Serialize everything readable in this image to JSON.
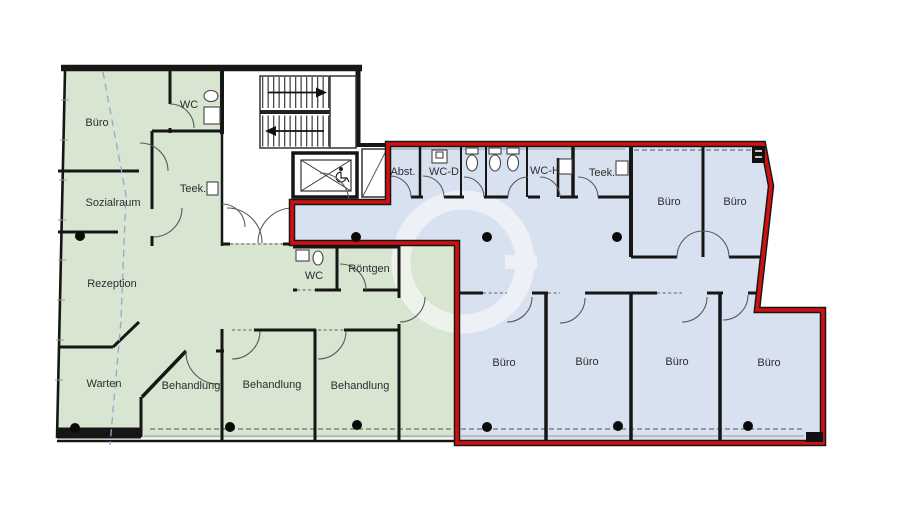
{
  "plan": {
    "type": "floor-plan",
    "colors": {
      "practice_area": "#d7e5d1",
      "office_area": "#d8e1ef",
      "unit_outline": "#d01111",
      "wall": "#161616",
      "section_line": "#8fa9cf"
    },
    "labels": {
      "practice": {
        "buero": "Büro",
        "wc": "WC",
        "sozialraum": "Sozialraum",
        "teek": "Teek.",
        "rezeption": "Rezeption",
        "warten": "Warten",
        "behandlung": "Behandlung",
        "roentgen": "Röntgen"
      },
      "office": {
        "abst": "Abst.",
        "wc_d": "WC-D",
        "wc_h": "WC-H",
        "teek": "Teek.",
        "buero": "Büro"
      }
    }
  }
}
